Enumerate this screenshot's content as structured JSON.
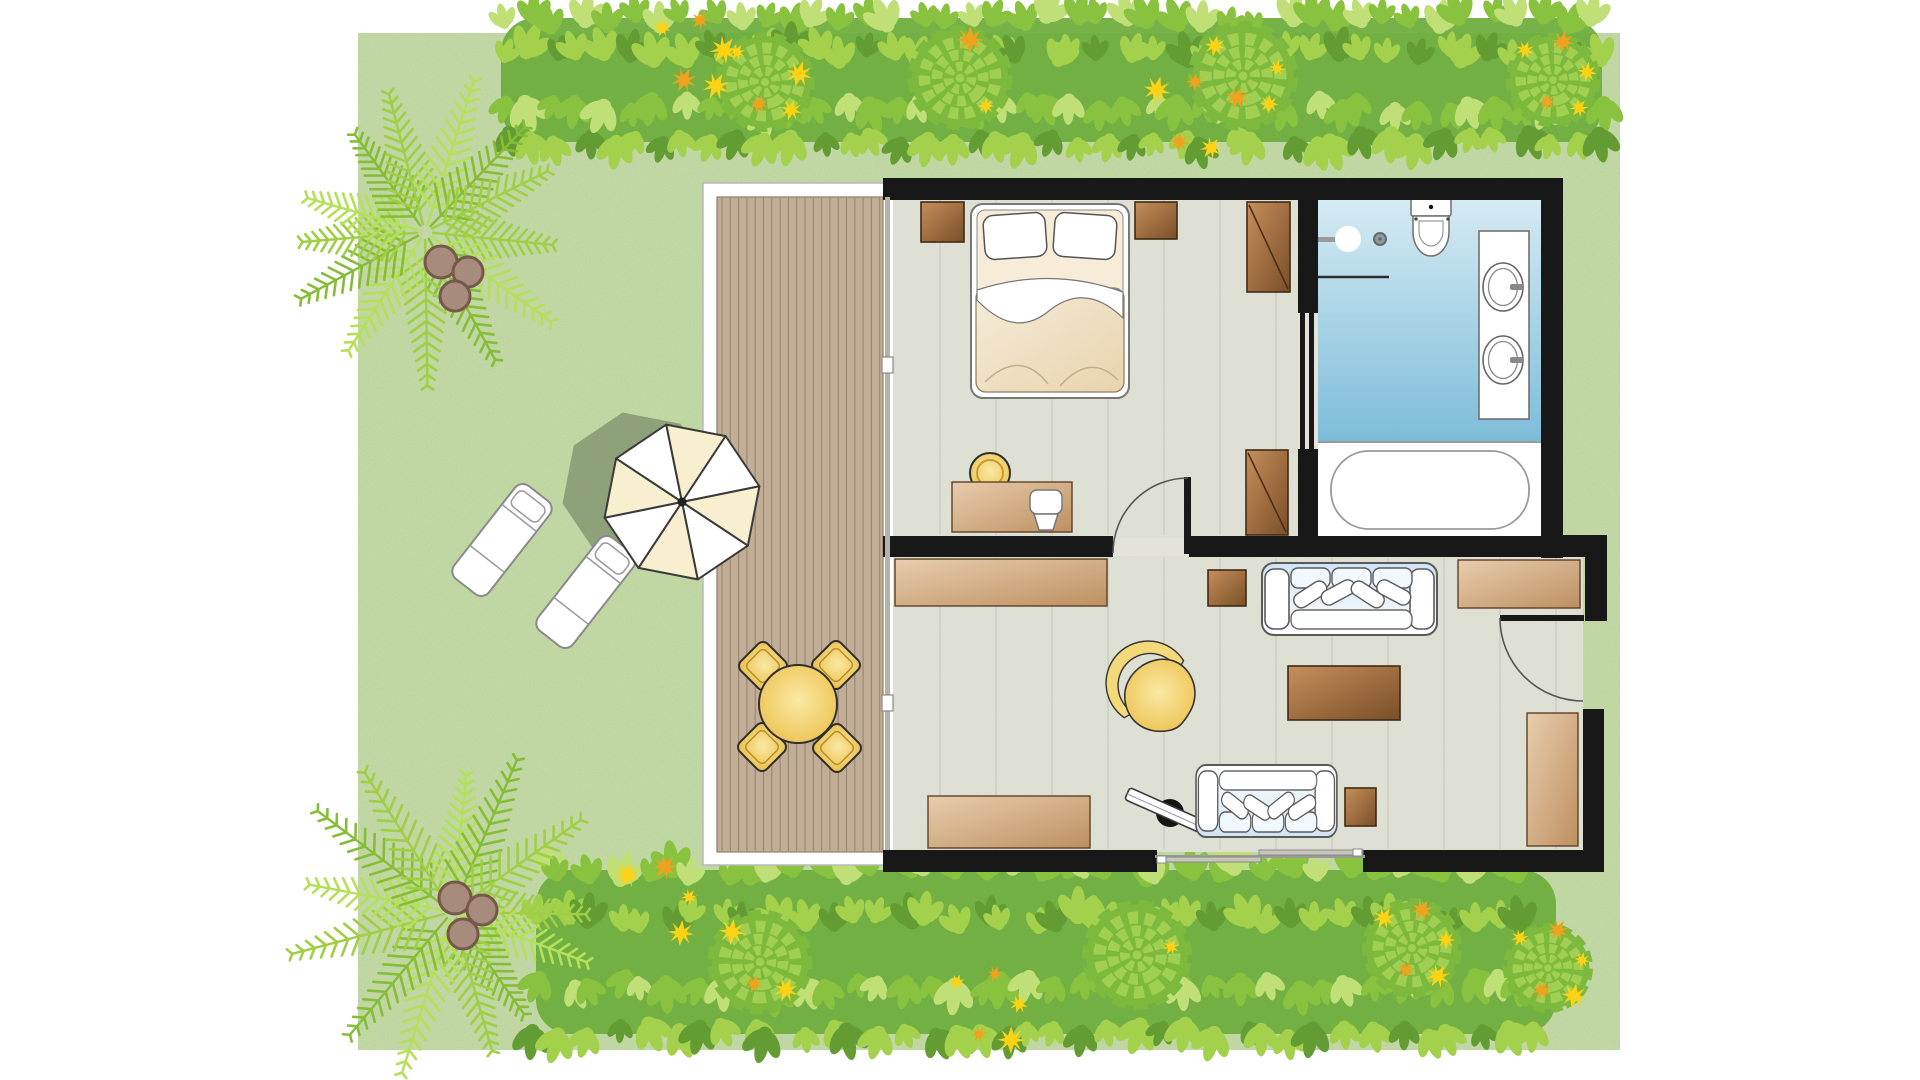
{
  "scene": "resort-villa-floor-plan-top-view",
  "palette": {
    "page_bg": "#ffffff",
    "lawn": "#cde3b1",
    "wall": "#181818",
    "floor": "#e3e3d9",
    "floor_seam": "#cfcfc2",
    "deck_wood": "#c2ad96",
    "deck_line": "#8f7d68",
    "glass": "#b3b3ab",
    "door_arc": "#555555",
    "fixture_line": "#6f6f6f",
    "bath_light": "#d6ebf3",
    "bath_deep": "#7cbcd9",
    "wood_dark_1": "#c68e5b",
    "wood_dark_2": "#7a4f28",
    "wood_light_1": "#e8cdad",
    "wood_light_2": "#bd9060",
    "yellow_1": "#fae9a4",
    "yellow_2": "#e9ba3e",
    "sofa_blue": "#cfe3f6",
    "bed_cream_1": "#f6ecd8",
    "bed_cream_2": "#e8d3ae",
    "hedge_base": "#6fae3e",
    "hedge_pale": "#c0df76",
    "hedge_light": "#a3d14c",
    "hedge_mid": "#88c23f",
    "hedge_dark": "#639c33",
    "rosette": "#7cb93d",
    "rosette_light": "#a0cf52",
    "flower_yellow": "#fed215",
    "flower_orange": "#f0a21e",
    "palm_light": "#b5e05a",
    "palm_mid": "#9ecf45",
    "palm_dark": "#86bd37",
    "coconut": "#a78b7d",
    "coconut_edge": "#77584a",
    "shadow": "#5c6b50",
    "umbrella_cream": "#f7efcf",
    "umbrella_line": "#3a3a3a",
    "tv_black": "#141414"
  },
  "labels": {
    "lawn": "garden lawn",
    "top_hedge": "flowering hedge",
    "bottom_hedge": "flowering hedge",
    "palm_top": "coconut palm tree",
    "palm_bottom": "coconut palm tree",
    "deck": "wooden deck",
    "umbrella": "patio umbrella",
    "umbrella_shadow": "umbrella shadow",
    "lounger_1": "sun lounger",
    "lounger_2": "sun lounger",
    "dining_table": "round outdoor table",
    "dining_chair": "outdoor chair",
    "bedroom": "bedroom",
    "bed": "double bed",
    "nightstand_left": "nightstand",
    "nightstand_right": "nightstand",
    "wardrobe_north": "wardrobe",
    "wardrobe_south": "wardrobe",
    "desk": "writing desk",
    "desk_chair": "desk chair",
    "stool": "round stool",
    "bathroom": "bathroom",
    "shower": "shower",
    "toilet": "toilet",
    "vanity": "double vanity",
    "bathtub": "bathtub",
    "bathroom_door": "sliding bathroom door",
    "living_room": "living room",
    "sideboard_north": "sideboard",
    "sideboard_south": "sideboard",
    "console": "console table",
    "sofa_north": "sofa",
    "sofa_south": "sofa",
    "side_table_north": "side table",
    "side_table_south": "side table",
    "coffee_table": "coffee table",
    "accent_chair": "accent chair",
    "tv": "television on stand",
    "cabinet": "tall cabinet",
    "interior_door": "interior door",
    "entrance_door": "entrance door",
    "patio_glass_door": "sliding glass door to deck",
    "south_glass_door": "sliding glass door to garden"
  },
  "rooms": {
    "garden": {
      "items": [
        "lawn",
        "hedge-with-flowers",
        "hedge-with-flowers",
        "coconut-palm",
        "coconut-palm",
        "sun-lounger",
        "sun-lounger",
        "patio-umbrella"
      ]
    },
    "deck": {
      "items": [
        "round-table",
        "chair",
        "chair",
        "chair",
        "chair"
      ]
    },
    "bedroom": {
      "items": [
        "double-bed",
        "nightstand",
        "nightstand",
        "wardrobe",
        "wardrobe",
        "desk",
        "desk-chair",
        "stool"
      ]
    },
    "bathroom": {
      "items": [
        "shower",
        "toilet",
        "double-vanity",
        "bathtub",
        "sliding-door"
      ]
    },
    "living_room": {
      "items": [
        "sofa",
        "sofa",
        "coffee-table",
        "side-table",
        "side-table",
        "sideboard",
        "sideboard",
        "console-table",
        "accent-chair",
        "tv",
        "tall-cabinet"
      ]
    }
  }
}
